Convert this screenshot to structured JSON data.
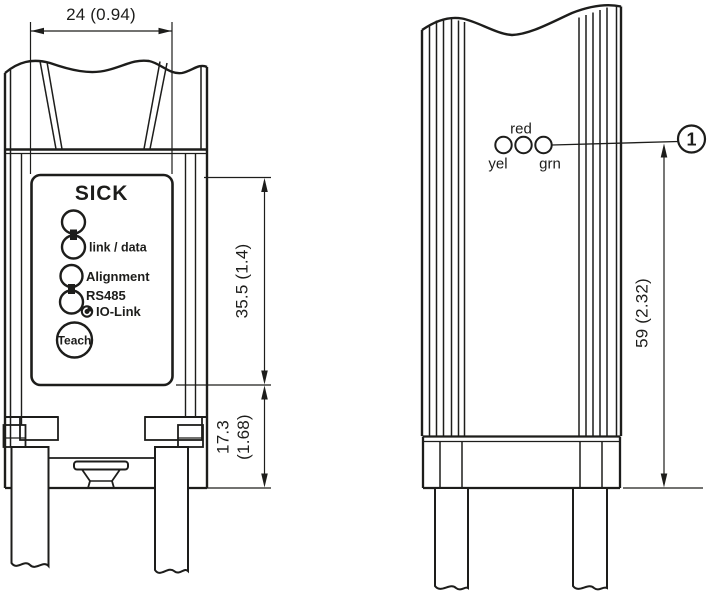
{
  "colors": {
    "line": "#1d1d1b",
    "background": "#ffffff"
  },
  "front_view": {
    "width_dimension": "24 (0.94)",
    "brand_logo": "SICK",
    "led_labels": {
      "link_data": "link / data",
      "alignment": "Alignment",
      "rs485": "RS485",
      "io_link": "IO-Link"
    },
    "teach_button_label": "Teach",
    "upper_height_dimension": "35.5 (1.4)",
    "lower_height_dimension_mm": "17.3",
    "lower_height_dimension_inch": "(1.68)"
  },
  "side_view": {
    "height_dimension": "59 (2.32)",
    "led_labels": {
      "red": "red",
      "yellow": "yel",
      "green": "grn"
    },
    "callout_number": "1"
  }
}
